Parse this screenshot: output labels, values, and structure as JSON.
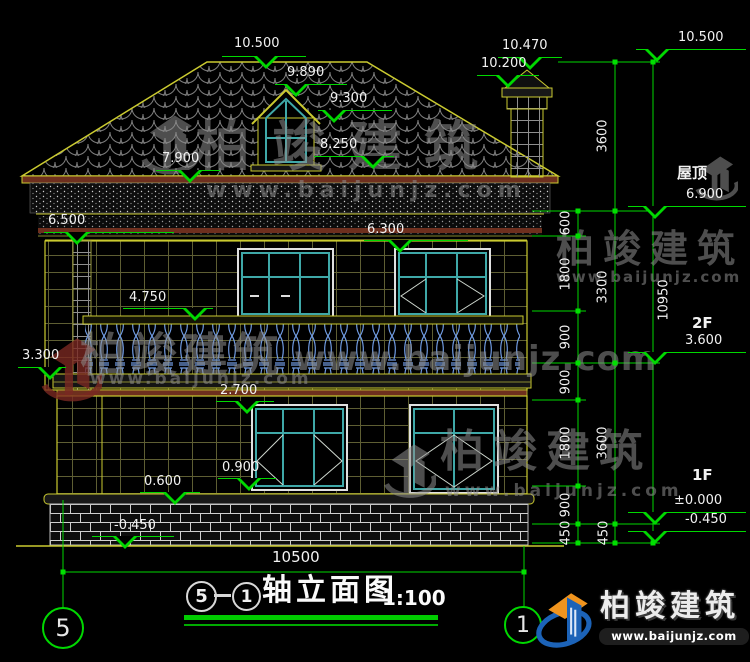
{
  "watermark_brand": "柏竣建筑",
  "watermark_site": "www.baijunjz.com",
  "levels": {
    "ridge": "10.500",
    "chimney_top": "10.470",
    "chimney_cap": "10.200",
    "dormer_ridge": "9.890",
    "dormer_eave": "9.300",
    "dormer_sill": "8.250",
    "main_eave": "7.900",
    "cornice_bottom": "6.500",
    "f2_window_top": "6.300",
    "balcony_rail": "4.750",
    "balcony_floor": "3.300",
    "f1_window_top": "2.700",
    "f1_window_sill": "0.900",
    "plinth_top": "0.600",
    "ground": "-0.450"
  },
  "right_panel": {
    "top_level": "10.500",
    "roof_label": "屋顶",
    "roof_level": "6.900",
    "f2_label": "2F",
    "f2_level": "3.600",
    "f1_label": "1F",
    "f1_level": "±0.000",
    "base_level": "-0.450",
    "inner_chain": [
      "600",
      "1800",
      "900",
      "900",
      "1800",
      "900",
      "450"
    ],
    "mid_chain": [
      "3600",
      "3300",
      "3600",
      "450"
    ],
    "total_height": "10950"
  },
  "bottom": {
    "overall_width": "10500",
    "axis_left": "5",
    "axis_right": "1"
  },
  "title_block": {
    "bubble_a": "5",
    "bubble_b": "1",
    "name": "轴立面图",
    "scale": "1:100"
  },
  "icons": {
    "watermark_logo": "building-swoosh-logo",
    "corner_logo": "building-swoosh-logo"
  },
  "colors": {
    "dim_green": "#00d800",
    "outline_yellow": "#caca30",
    "window_teal": "#3fa8a8",
    "baluster_blue": "#6f9ae0",
    "eave_red": "#6e2f1e",
    "logo_blue": "#1c63b8",
    "logo_orange": "#f0941e"
  }
}
